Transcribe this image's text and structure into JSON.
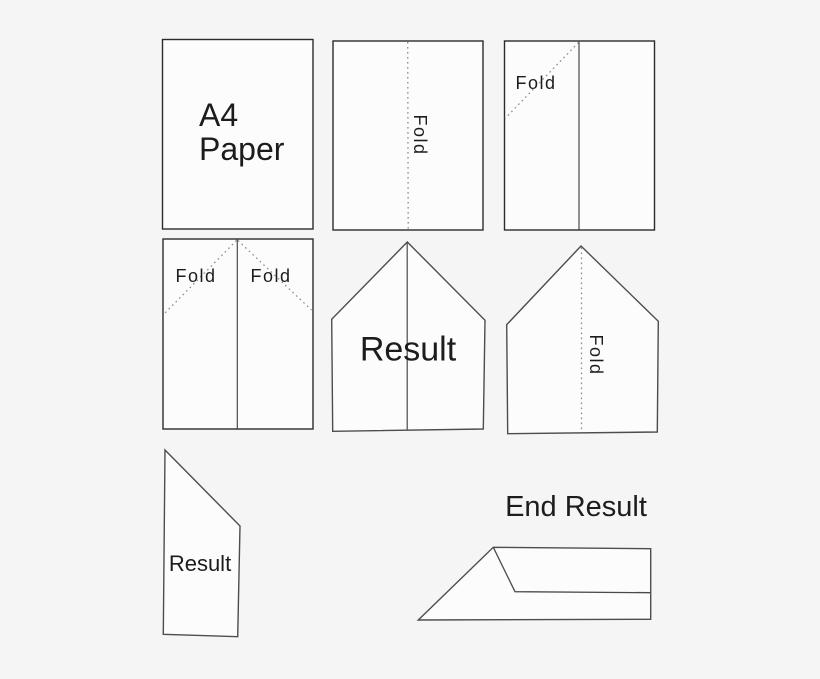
{
  "colors": {
    "canvas-bg": "#f5f5f5",
    "paper-fill": "#fcfcfc",
    "outline-dark": "#2b2b2b",
    "outline-gray": "#4d4d4d",
    "crease-gray": "#4a4a4a",
    "fold-dot": "#8e8e8e",
    "text": "#1c1c1c"
  },
  "diagram": {
    "step1": {
      "label": "A4\nPaper"
    },
    "step2": {
      "fold_label": "Fold"
    },
    "step3": {
      "fold_label": "Fold"
    },
    "step4": {
      "fold_label_left": "Fold",
      "fold_label_right": "Fold"
    },
    "step5": {
      "label": "Result"
    },
    "step6": {
      "fold_label": "Fold"
    },
    "step7": {
      "label": "Result"
    },
    "end_result": {
      "heading": "End Result"
    }
  }
}
